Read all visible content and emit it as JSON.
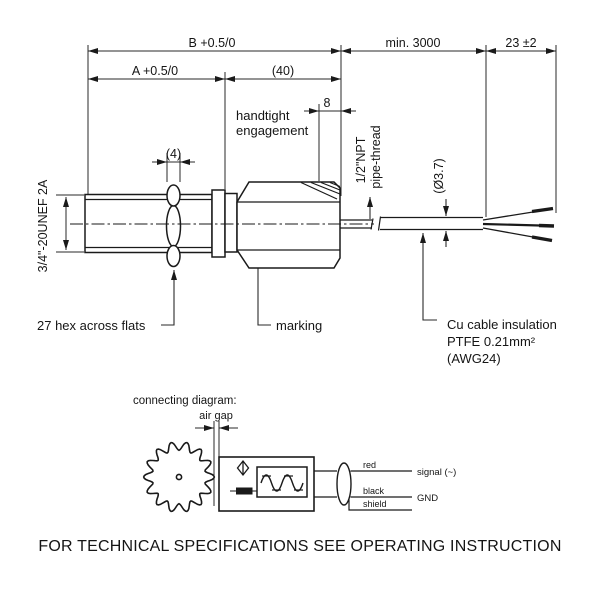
{
  "dims": {
    "b": "B +0.5/0",
    "a": "A +0.5/0",
    "len40": "(40)",
    "min3000": "min. 3000",
    "wire_len": "23 ±2",
    "npt_len": "8",
    "nut_w": "(4)",
    "cable_dia": "(Ø3.7)"
  },
  "labels": {
    "handtight1": "handtight",
    "handtight2": "engagement",
    "thread": "3/4\"-20UNEF 2A",
    "npt1": "1/2\"NPT",
    "npt2": "pipe-thread",
    "hex_flats": "27 hex across flats",
    "marking": "marking",
    "cable1": "Cu cable insulation",
    "cable2": "PTFE 0.21mm²",
    "cable3": "(AWG24)"
  },
  "diagram": {
    "title": "connecting diagram:",
    "air_gap": "air gap",
    "red": "red",
    "black": "black",
    "shield": "shield",
    "signal": "signal (~)",
    "gnd": "GND"
  },
  "footer": "FOR TECHNICAL SPECIFICATIONS SEE OPERATING INSTRUCTION"
}
